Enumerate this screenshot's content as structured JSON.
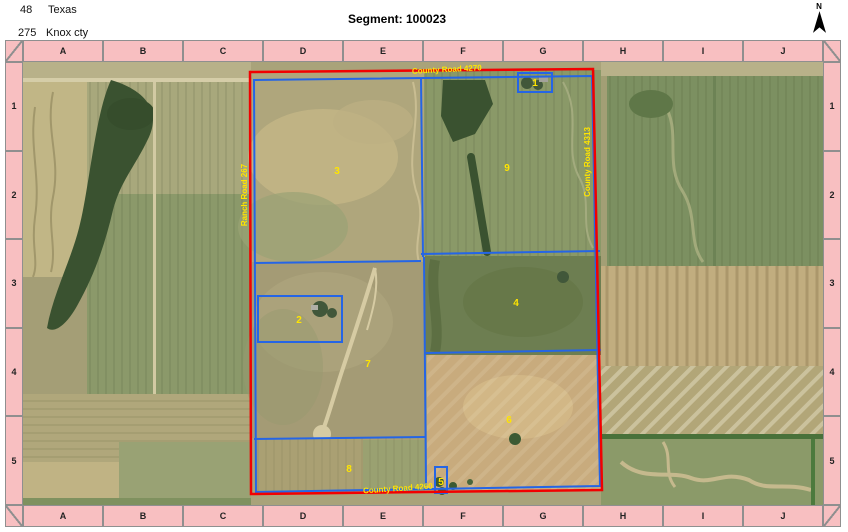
{
  "header": {
    "state_code": "48",
    "state_name": "Texas",
    "county_code": "275",
    "county_name": "Knox cty",
    "segment_title": "Segment: 100023",
    "north_label": "N"
  },
  "grid": {
    "column_labels": [
      "A",
      "B",
      "C",
      "D",
      "E",
      "F",
      "G",
      "H",
      "I",
      "J"
    ],
    "row_labels": [
      "1",
      "2",
      "3",
      "4",
      "5"
    ]
  },
  "map": {
    "colors": {
      "segment_boundary": "#f20000",
      "field_boundary": "#2565e6",
      "label": "#ffe500",
      "border_fill": "#f8bfc1"
    },
    "fields": [
      {
        "number": "1",
        "x": 512,
        "y": 24
      },
      {
        "number": "2",
        "x": 276,
        "y": 261
      },
      {
        "number": "3",
        "x": 314,
        "y": 112
      },
      {
        "number": "4",
        "x": 493,
        "y": 244
      },
      {
        "number": "5",
        "x": 418,
        "y": 423
      },
      {
        "number": "6",
        "x": 486,
        "y": 361
      },
      {
        "number": "7",
        "x": 345,
        "y": 305
      },
      {
        "number": "8",
        "x": 326,
        "y": 410
      },
      {
        "number": "9",
        "x": 484,
        "y": 109
      }
    ],
    "roads": [
      {
        "name": "County Road 4270",
        "x": 424,
        "y": 10,
        "rotation": -3
      },
      {
        "name": "Ranch Road 267",
        "x": 224,
        "y": 133,
        "rotation": -90
      },
      {
        "name": "County Road 4313",
        "x": 567,
        "y": 100,
        "rotation": -90
      },
      {
        "name": "County Road 4260",
        "x": 375,
        "y": 429,
        "rotation": -4
      }
    ]
  }
}
